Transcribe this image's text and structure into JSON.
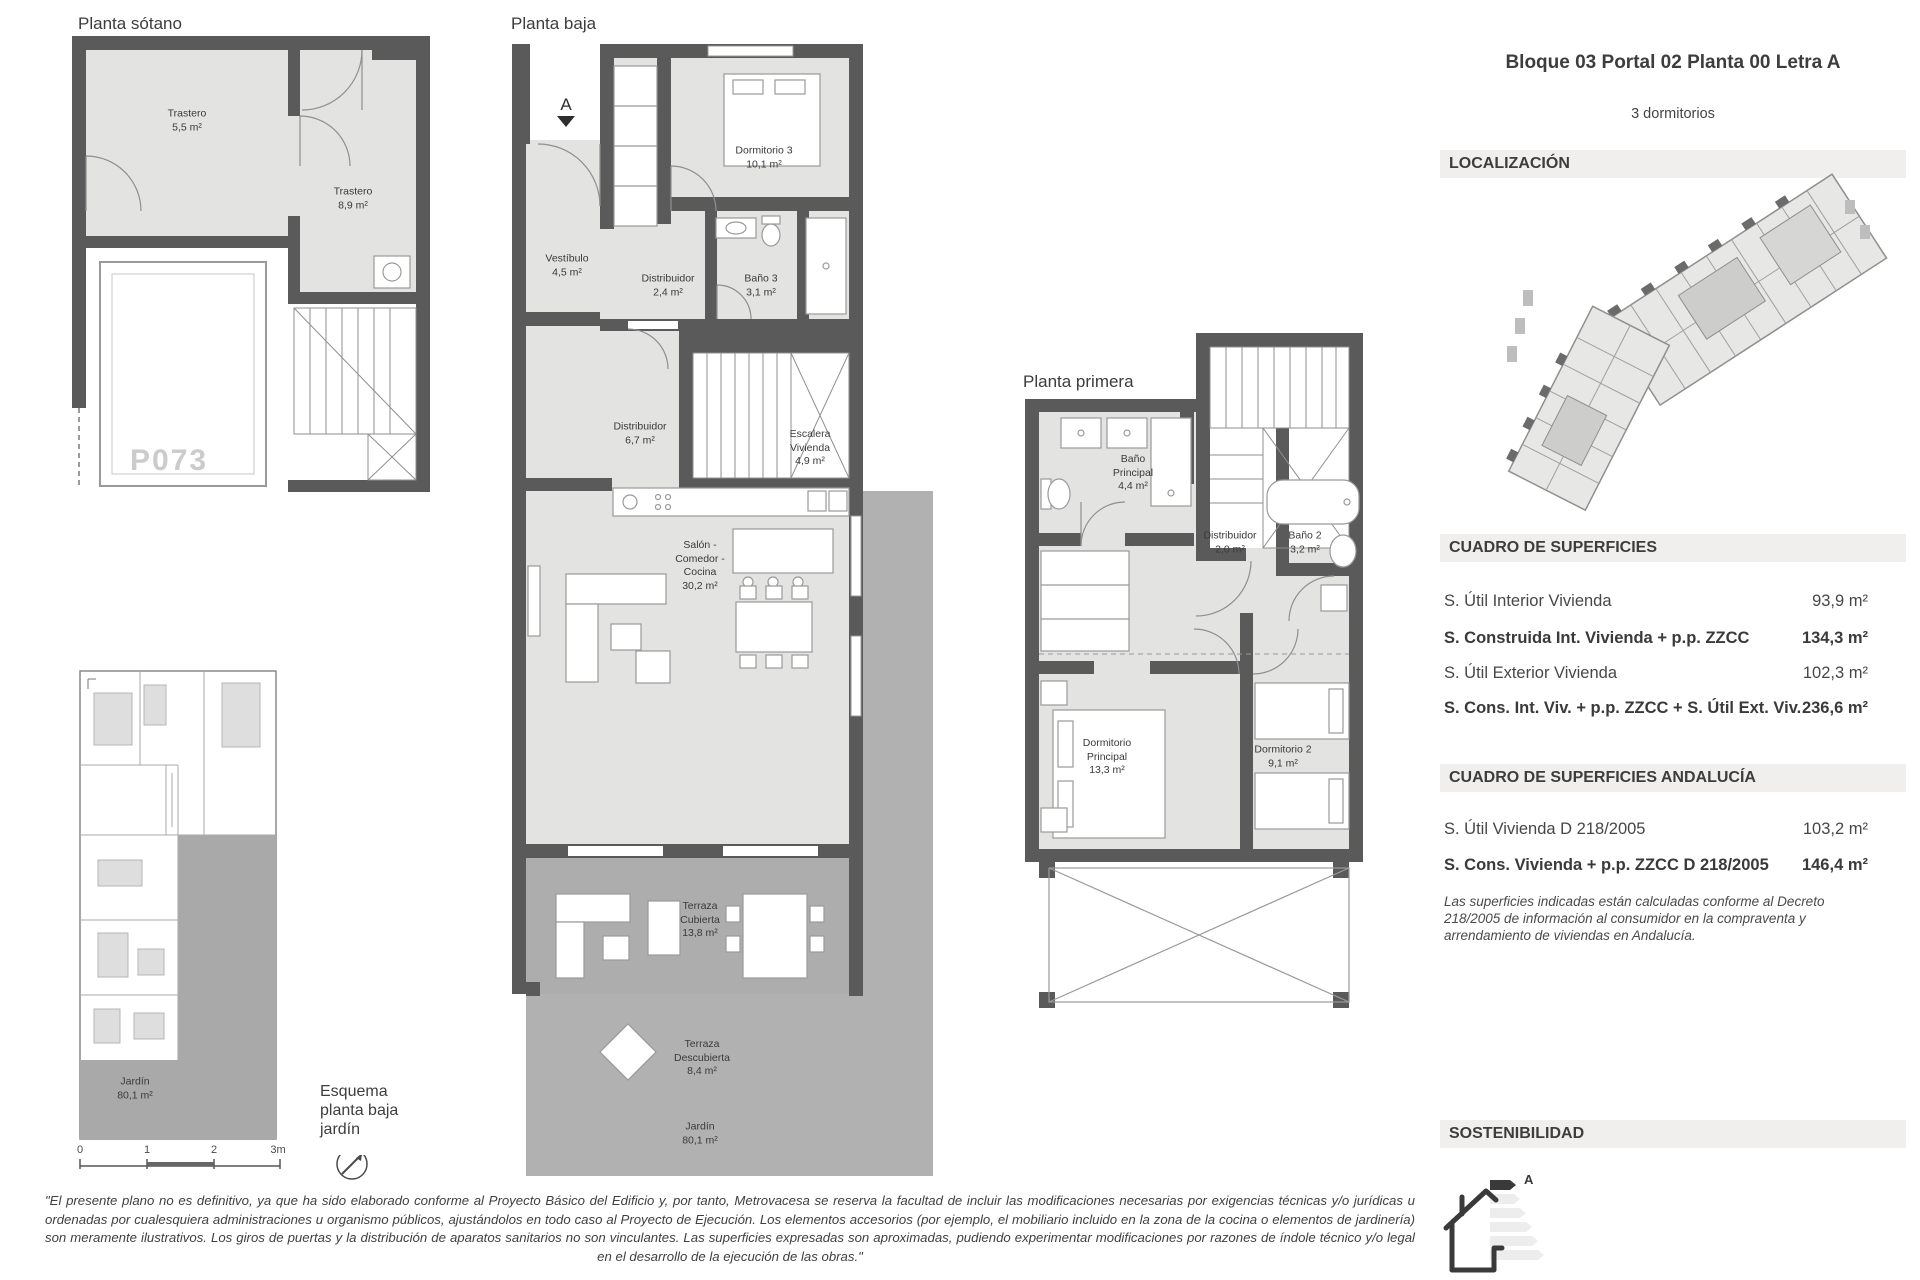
{
  "header": {
    "title": "Bloque 03 Portal 02 Planta 00 Letra A",
    "subtitle": "3 dormitorios"
  },
  "sections": {
    "localizacion": "LOCALIZACIÓN",
    "superficies": "CUADRO DE SUPERFICIES",
    "andalucia": "CUADRO DE SUPERFICIES ANDALUCÍA",
    "sostenibilidad": "SOSTENIBILIDAD"
  },
  "superficies_rows": [
    {
      "label": "S. Útil Interior Vivienda",
      "value": "93,9 m²"
    },
    {
      "label": "S. Construida Int. Vivienda + p.p. ZZCC",
      "value": "134,3 m²"
    },
    {
      "label": "S. Útil Exterior Vivienda",
      "value": "102,3 m²"
    },
    {
      "label": "S. Cons. Int. Viv. + p.p. ZZCC + S. Útil Ext. Viv.",
      "value": "236,6 m²"
    }
  ],
  "andalucia_rows": [
    {
      "label": "S. Útil Vivienda D 218/2005",
      "value": "103,2 m²"
    },
    {
      "label": "S. Cons. Vivienda + p.p. ZZCC D 218/2005",
      "value": "146,4 m²"
    }
  ],
  "andalucia_note": "Las superficies indicadas están calculadas conforme al Decreto 218/2005 de información al consumidor en la compraventa y arrendamiento de viviendas en Andalucía.",
  "energy": {
    "rating": "A"
  },
  "plans": {
    "sotano": {
      "title": "Planta sótano",
      "parking": "P073",
      "rooms": [
        {
          "name": "Trastero",
          "area": "5,5 m²"
        },
        {
          "name": "Trastero",
          "area": "8,9 m²"
        }
      ]
    },
    "baja": {
      "title": "Planta baja",
      "entrance": "A",
      "rooms": [
        {
          "name": "Dormitorio 3",
          "area": "10,1 m²"
        },
        {
          "name": "Vestíbulo",
          "area": "4,5 m²"
        },
        {
          "name": "Distribuidor",
          "area": "2,4 m²"
        },
        {
          "name": "Baño 3",
          "area": "3,1 m²"
        },
        {
          "name": "Distribuidor",
          "area": "6,7 m²"
        },
        {
          "name": "Escalera Vivienda",
          "area": "4,9 m²"
        },
        {
          "name": "Salón - Comedor - Cocina",
          "area": "30,2 m²"
        },
        {
          "name": "Terraza Cubierta",
          "area": "13,8 m²"
        },
        {
          "name": "Terraza Descubierta",
          "area": "8,4 m²"
        },
        {
          "name": "Jardín",
          "area": "80,1 m²"
        }
      ]
    },
    "primera": {
      "title": "Planta primera",
      "rooms": [
        {
          "name": "Baño Principal",
          "area": "4,4 m²"
        },
        {
          "name": "Distribuidor",
          "area": "2,0 m²"
        },
        {
          "name": "Baño 2",
          "area": "3,2 m²"
        },
        {
          "name": "Dormitorio Principal",
          "area": "13,3 m²"
        },
        {
          "name": "Dormitorio 2",
          "area": "9,1 m²"
        }
      ]
    }
  },
  "esquema": {
    "caption": "Esquema planta baja jardín",
    "jardin": {
      "name": "Jardín",
      "area": "80,1 m²"
    },
    "scale": [
      "0",
      "1",
      "2",
      "3m"
    ]
  },
  "colors": {
    "wall": "#5a5a5a",
    "room_floor": "#e3e3e2",
    "exterior_gray": "#b1b1b1",
    "header_bar": "#f0efee"
  },
  "disclaimer": "\"El presente plano no es definitivo, ya que ha sido elaborado conforme al Proyecto Básico del Edificio y, por tanto, Metrovacesa se reserva la facultad de incluir las modificaciones necesarias por exigencias técnicas y/o jurídicas u ordenadas por cualesquiera administraciones u organismo públicos, ajustándolos en todo caso al Proyecto de Ejecución. Los elementos accesorios (por ejemplo, el mobiliario incluido en la zona de la cocina o elementos de jardinería) son meramente ilustrativos. Los giros de puertas y la distribución de aparatos sanitarios no son vinculantes. Las superficies expresadas son aproximadas, pudiendo experimentar modificaciones por razones de índole técnico y/o legal en el desarrollo de la ejecución de las obras.\""
}
